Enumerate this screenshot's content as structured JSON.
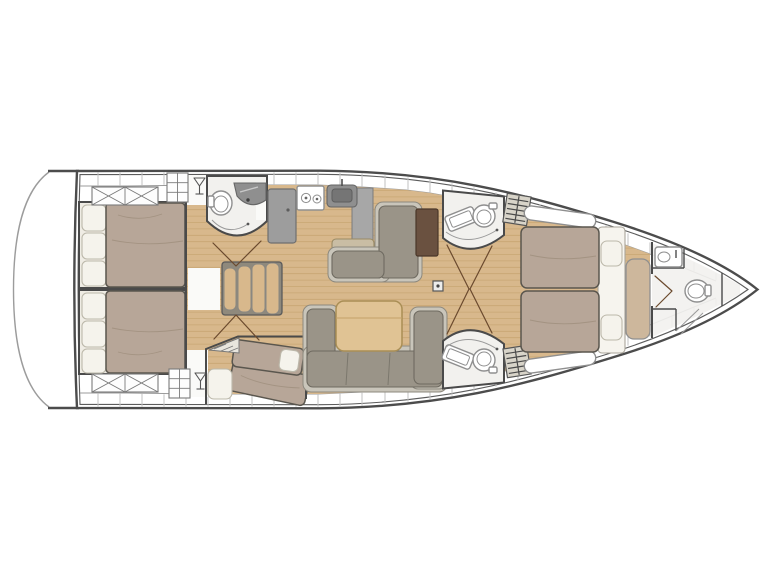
{
  "meta": {
    "type": "floor-plan-diagram",
    "subject": "sailing-yacht-interior-layout",
    "orientation": "bow-right-stern-left",
    "visible_text": "",
    "background": "#ffffff"
  },
  "colors": {
    "hull_line": "#4c4c4c",
    "hull_inner_line": "#5c5c5c",
    "transom_line": "#9c9c9c",
    "deck_line": "#9b9b9b",
    "deck_tick": "#c2c2c2",
    "floor_wood": "#d8b88c",
    "plank_line": "#c6a46f",
    "wall": "#4a4a4a",
    "bath_floor": "#f2f1ee",
    "fixture": "#ffffff",
    "fixture_border": "#8f8f8f",
    "bed": "#b7a698",
    "bed_border": "#5a564e",
    "bed_crease": "#a08f7e",
    "pillow": "#f5f3ec",
    "pillow_border": "#bcb8aa",
    "sofa": "#9a9488",
    "sofa_base": "#c9c5ba",
    "sofa_border": "#6e6a60",
    "table_wood": "#e0c394",
    "table_border": "#a98e55",
    "chart_table": "#6a5140",
    "counter": "#a7a7a7",
    "counter_border": "#7b7b7b",
    "appliance": "#9d9d9d",
    "sink": "#8f8f8f",
    "sink_basin": "#757575",
    "bench": "#cdb79c",
    "door_arc": "#6b4a2e",
    "shower_arc": "#9a9a9a",
    "hatch_bg": "#fdfdfd",
    "hatch_border": "#7a7a7a",
    "grate_line": "#4a4a4a",
    "grate_bg": "#d8d4c9",
    "white_patch": "#fafaf8"
  },
  "rooms": {
    "transom": {
      "name": "Transom / swim platform outline"
    },
    "aft_cabin_port": {
      "name": "Aft double cabin (top/port)"
    },
    "aft_cabin_starboard": {
      "name": "Aft double cabin (bottom/starboard)"
    },
    "aft_head": {
      "name": "Aft head with toilet and vanity"
    },
    "companionway": {
      "name": "Companionway stairs"
    },
    "galley": {
      "name": "Galley with stove, sink and refrigerator"
    },
    "nav_station": {
      "name": "Settee with chart table"
    },
    "salon": {
      "name": "Salon with U-shaped sofa and table"
    },
    "bunk_cabin": {
      "name": "Twin berth cabin (bottom amidships)"
    },
    "head_top": {
      "name": "En-suite head with shower seat and toilet (top)"
    },
    "head_bottom": {
      "name": "En-suite head with shower seat and toilet (bottom)"
    },
    "owner_cabin": {
      "name": "Forward owner's cabin with island double bed"
    },
    "bow_head": {
      "name": "Bow head with sink, toilet and shower"
    }
  },
  "features": {
    "stove_burners": 2,
    "companionway_treads": 4,
    "aft_cabin_pillows_each": 3,
    "owner_cabin_pillows": 2,
    "deck_hatches_x_per_aft_cabin": 2,
    "toilets_visible": 4,
    "shower_seats_visible": 2,
    "double_beds": 3,
    "single_berths": 2
  }
}
